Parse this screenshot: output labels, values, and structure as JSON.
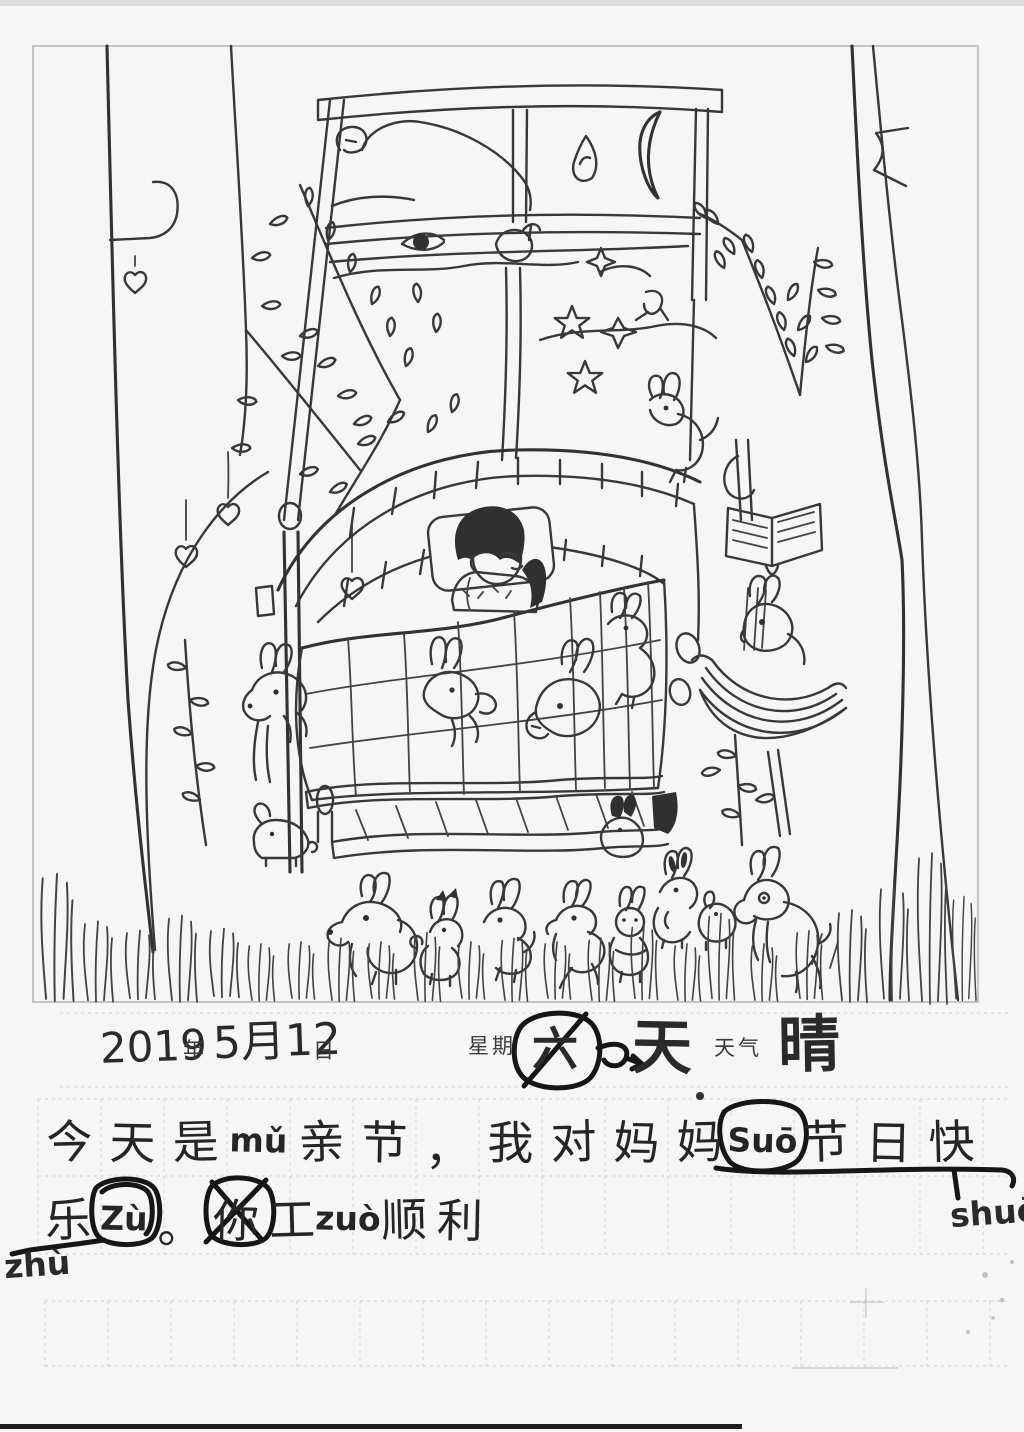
{
  "page": {
    "background": "#f7f6f2",
    "ink": "#3a3836",
    "annotation_ink": "#161614",
    "grid_line": "#b6bfc6"
  },
  "date_line": {
    "year": "2019",
    "year_label": "年",
    "month_day": "5月12",
    "day_label": "日",
    "weekday_label": "星期",
    "weekday_original": "六",
    "weekday_correction": "天",
    "weather_label": "天气",
    "weather_value": "晴"
  },
  "diary": {
    "line1_cells": [
      "今",
      "天",
      "是",
      "mǔ",
      "亲",
      "节",
      "，",
      "我",
      "对",
      "妈",
      "妈",
      "Suō",
      "节",
      "日",
      "快"
    ],
    "line2_cells": [
      "乐",
      "Zù",
      "。",
      "你",
      "工",
      "zuò",
      "顺",
      "利"
    ],
    "margin_note_right": "shuō",
    "margin_note_left": "zhù"
  },
  "drawing": {
    "caption": "Child's ink drawing: a girl asleep in a big bed beneath a night window with crescent moon and stars, trees on both sides, hanging fruit, and many rabbits in the grass",
    "elements": [
      "drawing-frame",
      "left-tree",
      "hanging-fruit",
      "right-tree",
      "window-curtain",
      "clouds",
      "crescent-moon",
      "stars",
      "bed-canopy",
      "pillow",
      "sleeping-child",
      "quilt",
      "quilt-rabbits",
      "footboard",
      "book-stand",
      "rabbit-nest",
      "bottom-rabbits",
      "grass-tufts",
      "correction-circles",
      "underline-marks"
    ]
  }
}
